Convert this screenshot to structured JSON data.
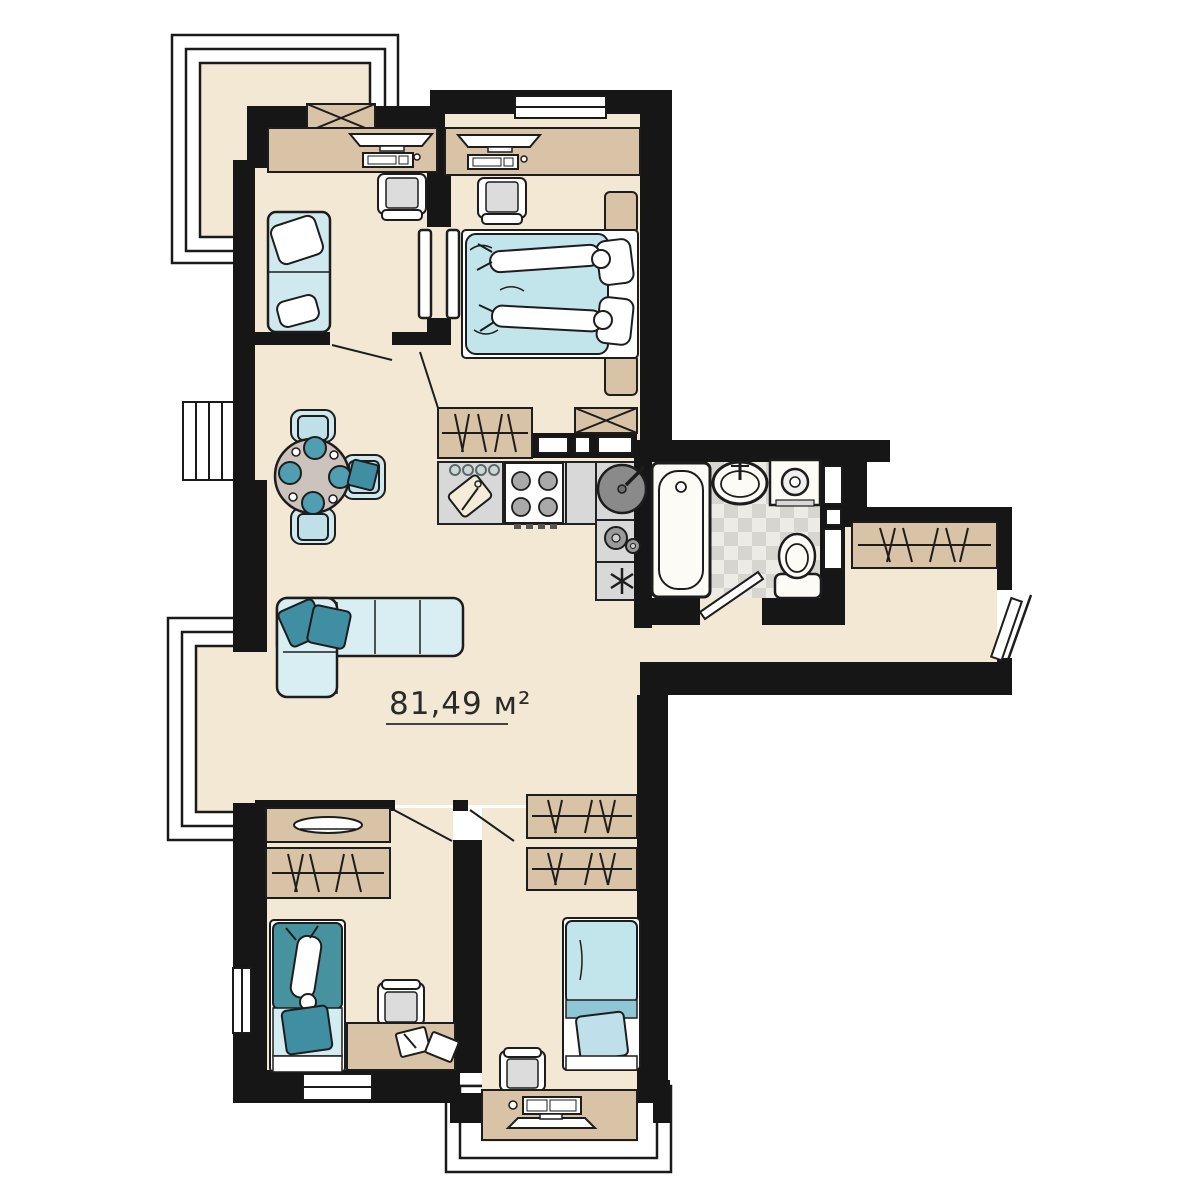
{
  "floorplan": {
    "area_label": "81,49 м²",
    "palette": {
      "wall": "#161616",
      "line": "#1d1d1d",
      "floor": "#f2e8d4",
      "wood": "#d9c3a6",
      "counter": "#d8d8d8",
      "blue_light": "#cfe9ef",
      "blue_blanket": "#c2e5ec",
      "teal": "#3f8ea1",
      "kid_blanket_teal": "#46929f",
      "checker_light": "#edebe6",
      "checker_dark": "#d7d5d0",
      "table": "#ccc4bc",
      "plate_teal": "#4f9eb2",
      "appliance_gray": "#9a9a9a",
      "white": "#ffffff"
    }
  }
}
